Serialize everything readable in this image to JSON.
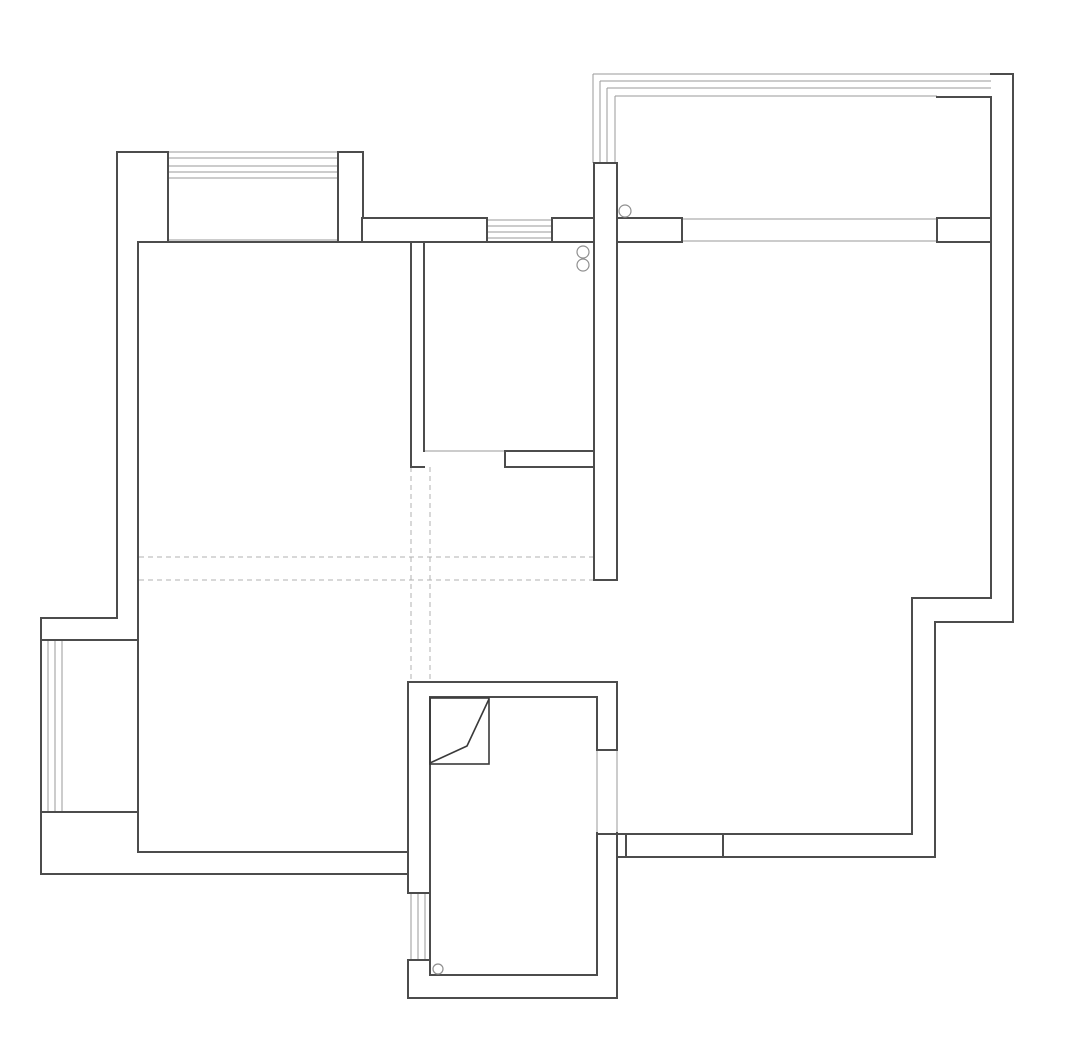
{
  "canvas": {
    "width": 1080,
    "height": 1058,
    "background": "#ffffff"
  },
  "palette": {
    "wall_stroke": "#4c4c4c",
    "window_stroke": "#9a9a9a",
    "dashed_stroke": "#b0b0b0",
    "pipe_stroke": "#8f8f8f",
    "flue_stroke": "#3a3a3a",
    "fill": "#ffffff"
  },
  "stroke_widths": {
    "wall": 2,
    "window": 1,
    "dashed": 1,
    "pipe": 1.2,
    "flue": 1.6
  },
  "floorplan": {
    "wall_lines": [
      [
        117,
        152,
        168,
        152
      ],
      [
        117,
        152,
        117,
        618
      ],
      [
        168,
        152,
        168,
        240
      ],
      [
        363,
        152,
        363,
        218
      ],
      [
        594,
        163,
        594,
        580
      ],
      [
        617,
        163,
        617,
        580
      ],
      [
        594,
        163,
        617,
        163
      ],
      [
        594,
        580,
        617,
        580
      ],
      [
        937,
        218,
        991,
        218
      ],
      [
        937,
        218,
        937,
        242
      ],
      [
        937,
        242,
        991,
        242
      ],
      [
        937,
        97,
        991,
        97
      ],
      [
        991,
        74,
        1013,
        74
      ],
      [
        1013,
        74,
        1013,
        622
      ],
      [
        991,
        97,
        991,
        598
      ],
      [
        912,
        598,
        991,
        598
      ],
      [
        935,
        622,
        1013,
        622
      ],
      [
        912,
        598,
        912,
        834
      ],
      [
        935,
        622,
        935,
        857
      ],
      [
        597,
        834,
        912,
        834
      ],
      [
        617,
        857,
        935,
        857
      ],
      [
        626,
        834,
        626,
        857
      ],
      [
        723,
        834,
        723,
        857
      ],
      [
        139,
        242,
        594,
        242
      ],
      [
        411,
        242,
        411,
        467
      ],
      [
        424,
        242,
        424,
        451
      ],
      [
        411,
        467,
        424,
        467
      ],
      [
        408,
        682,
        617,
        682
      ],
      [
        430,
        697,
        597,
        697
      ],
      [
        408,
        682,
        408,
        893
      ],
      [
        430,
        697,
        430,
        975
      ],
      [
        597,
        697,
        597,
        750
      ],
      [
        617,
        682,
        617,
        750
      ],
      [
        597,
        750,
        617,
        750
      ],
      [
        597,
        833,
        597,
        975
      ],
      [
        617,
        833,
        617,
        998
      ],
      [
        408,
        893,
        428,
        893
      ],
      [
        408,
        960,
        428,
        960
      ],
      [
        408,
        960,
        408,
        998
      ],
      [
        430,
        975,
        597,
        975
      ],
      [
        408,
        998,
        617,
        998
      ],
      [
        138,
        242,
        138,
        852
      ],
      [
        41,
        618,
        117,
        618
      ],
      [
        41,
        640,
        138,
        640
      ],
      [
        41,
        812,
        138,
        812
      ],
      [
        41,
        618,
        41,
        874
      ],
      [
        138,
        852,
        408,
        852
      ],
      [
        41,
        874,
        408,
        874
      ]
    ],
    "wall_rects": [
      [
        338,
        152,
        25,
        90
      ],
      [
        362,
        218,
        125,
        24
      ],
      [
        552,
        218,
        42,
        24
      ],
      [
        617,
        218,
        65,
        24
      ],
      [
        505,
        451,
        89,
        16
      ]
    ],
    "window_lines": [
      [
        168,
        152,
        338,
        152
      ],
      [
        168,
        158,
        338,
        158
      ],
      [
        168,
        166,
        338,
        166
      ],
      [
        168,
        172,
        338,
        172
      ],
      [
        168,
        178,
        338,
        178
      ],
      [
        168,
        240,
        338,
        240
      ],
      [
        487,
        220,
        552,
        220
      ],
      [
        487,
        226,
        552,
        226
      ],
      [
        487,
        232,
        552,
        232
      ],
      [
        487,
        238,
        552,
        238
      ],
      [
        593,
        74,
        991,
        74
      ],
      [
        593,
        74,
        593,
        163
      ],
      [
        600,
        81,
        991,
        81
      ],
      [
        600,
        81,
        600,
        163
      ],
      [
        607,
        88,
        991,
        88
      ],
      [
        607,
        88,
        607,
        163
      ],
      [
        615,
        96,
        937,
        96
      ],
      [
        615,
        96,
        615,
        163
      ],
      [
        682,
        219,
        937,
        219
      ],
      [
        682,
        241,
        937,
        241
      ],
      [
        48,
        640,
        48,
        812
      ],
      [
        55,
        640,
        55,
        812
      ],
      [
        62,
        640,
        62,
        812
      ],
      [
        411,
        893,
        411,
        960
      ],
      [
        418,
        893,
        418,
        960
      ],
      [
        425,
        893,
        425,
        960
      ],
      [
        597,
        750,
        597,
        833
      ],
      [
        617,
        750,
        617,
        833
      ],
      [
        424,
        451,
        505,
        451
      ]
    ],
    "dashed_lines": [
      [
        411,
        467,
        411,
        682
      ],
      [
        430,
        467,
        430,
        682
      ],
      [
        139,
        557,
        594,
        557
      ],
      [
        139,
        580,
        594,
        580
      ]
    ],
    "pipe_circles": [
      [
        625,
        211,
        6
      ],
      [
        583,
        252,
        6
      ],
      [
        583,
        265,
        6
      ],
      [
        438,
        969,
        5
      ]
    ],
    "flue_duct": {
      "rect": [
        430,
        698,
        59,
        66
      ],
      "polyline": [
        [
          489,
          699
        ],
        [
          467,
          746
        ],
        [
          430,
          763
        ]
      ]
    }
  }
}
